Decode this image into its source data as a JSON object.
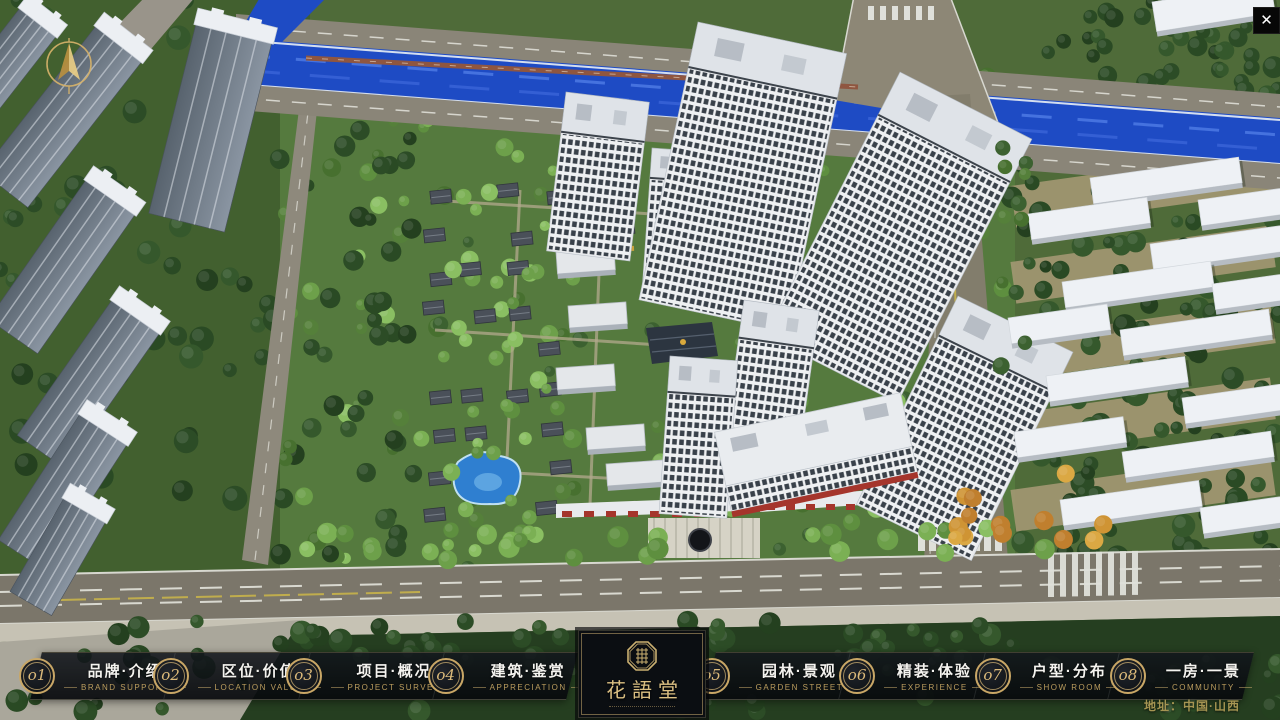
{
  "window": {
    "icons": {
      "close": "✕",
      "compass": "north-arrow",
      "logo_seal": "octagon-seal"
    }
  },
  "scene": {
    "description": "aerial-3d-masterplan-render",
    "colors": {
      "river": "#1e4bc4",
      "road": "#7b766a",
      "greenery": "#4f6b39",
      "tower_facade": "#e8eaed",
      "gold_accent": "#c9a766",
      "nav_background": "#0b0e12"
    }
  },
  "brand": {
    "logo_name": "花語堂"
  },
  "nav": {
    "items": [
      {
        "num": "o1",
        "title": "品牌·介绍",
        "caption": "BRAND SUPPORT"
      },
      {
        "num": "o2",
        "title": "区位·价值",
        "caption": "LOCATION VALUE"
      },
      {
        "num": "o3",
        "title": "项目·概况",
        "caption": "PROJECT SURVEY"
      },
      {
        "num": "o4",
        "title": "建筑·鉴赏",
        "caption": "APPRECIATION"
      },
      {
        "num": "o5",
        "title": "园林·景观",
        "caption": "GARDEN STREET"
      },
      {
        "num": "o6",
        "title": "精装·体验",
        "caption": "EXPERIENCE"
      },
      {
        "num": "o7",
        "title": "户型·分布",
        "caption": "SHOW ROOM"
      },
      {
        "num": "o8",
        "title": "一房·一景",
        "caption": "COMMUNITY"
      }
    ]
  },
  "footer": {
    "address": "地址：中国·山西"
  }
}
